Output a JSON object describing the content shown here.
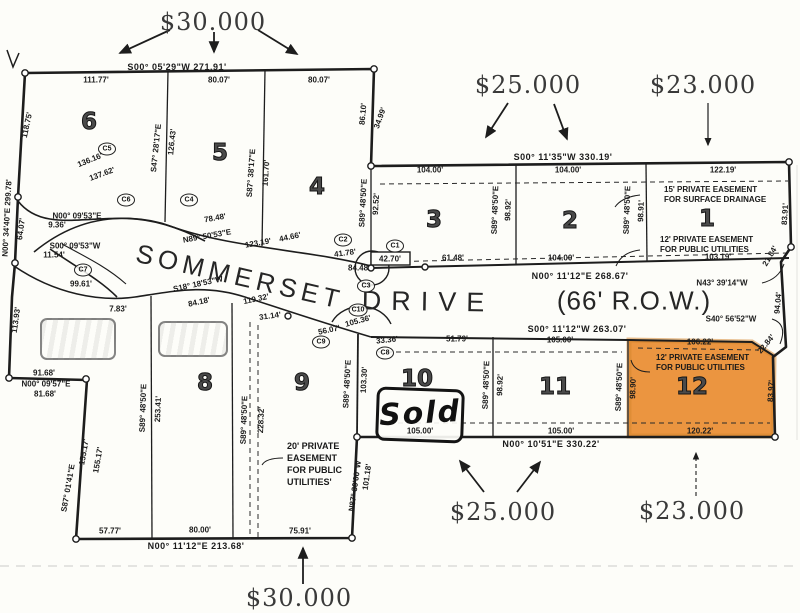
{
  "colors": {
    "paper": "#fdfdf9",
    "ink": "#1d1d1d",
    "lot12_highlight": "#ea8a2c"
  },
  "prices": {
    "top_30": "$30.000",
    "top_25": "$25.000",
    "top_23": "$23.000",
    "bottom_25": "$25.000",
    "bottom_23": "$23.000",
    "bottom_30": "$30.000"
  },
  "street": {
    "sommerset": "SOMMERSET",
    "drive": "DRIVE",
    "row": "(66' R.O.W.)"
  },
  "annotations": {
    "sold": "Sold"
  },
  "easements": {
    "surface_ne": "15' PRIVATE EASEMENT\nFOR SURFACE DRAINAGE",
    "utilities_ne": "12' PRIVATE EASEMENT\nFOR PUBLIC UTILITIES",
    "utilities_lot12": "12' PRIVATE EASEMENT\nFOR PUBLIC UTILITIES",
    "utilities_sw": "20' PRIVATE\nEASEMENT\nFOR PUBLIC\nUTILITIES'"
  },
  "lots": [
    {
      "n": "6",
      "x": 89,
      "y": 122
    },
    {
      "n": "5",
      "x": 220,
      "y": 153
    },
    {
      "n": "4",
      "x": 317,
      "y": 187
    },
    {
      "n": "3",
      "x": 434,
      "y": 220
    },
    {
      "n": "2",
      "x": 570,
      "y": 221
    },
    {
      "n": "1",
      "x": 707,
      "y": 219
    },
    {
      "n": "8",
      "x": 205,
      "y": 383
    },
    {
      "n": "9",
      "x": 302,
      "y": 383
    },
    {
      "n": "10",
      "x": 417,
      "y": 379
    },
    {
      "n": "11",
      "x": 555,
      "y": 387
    },
    {
      "n": "12",
      "x": 692,
      "y": 387
    }
  ],
  "curve_labels": [
    {
      "t": "C1",
      "x": 395,
      "y": 246
    },
    {
      "t": "C2",
      "x": 343,
      "y": 240
    },
    {
      "t": "C3",
      "x": 366,
      "y": 286
    },
    {
      "t": "C4",
      "x": 189,
      "y": 200
    },
    {
      "t": "C5",
      "x": 107,
      "y": 149
    },
    {
      "t": "C6",
      "x": 126,
      "y": 200
    },
    {
      "t": "C7",
      "x": 83,
      "y": 270
    },
    {
      "t": "C8",
      "x": 385,
      "y": 353
    },
    {
      "t": "C9",
      "x": 321,
      "y": 342
    },
    {
      "t": "C10",
      "x": 358,
      "y": 310
    }
  ],
  "dim_labels": [
    {
      "t": "S00° 05'29\"W   271.91'",
      "x": 177,
      "y": 67,
      "big": 1
    },
    {
      "t": "111.77'",
      "x": 96,
      "y": 80
    },
    {
      "t": "80.07'",
      "x": 219,
      "y": 80
    },
    {
      "t": "80.07'",
      "x": 319,
      "y": 80
    },
    {
      "t": "118.75'",
      "x": 27,
      "y": 125,
      "r": -78
    },
    {
      "t": "136.16'",
      "x": 90,
      "y": 160,
      "r": -22
    },
    {
      "t": "137.62'",
      "x": 102,
      "y": 174,
      "r": -20
    },
    {
      "t": "S47° 28'17\"E",
      "x": 156,
      "y": 148,
      "r": -84
    },
    {
      "t": "126.43'",
      "x": 172,
      "y": 142,
      "r": -84
    },
    {
      "t": "S87° 38'17\"E",
      "x": 251,
      "y": 173,
      "r": -86
    },
    {
      "t": "161.70'",
      "x": 266,
      "y": 173,
      "r": -86
    },
    {
      "t": "86.10'",
      "x": 363,
      "y": 114,
      "r": -85
    },
    {
      "t": "34.99'",
      "x": 380,
      "y": 118,
      "r": -70
    },
    {
      "t": "S89° 48'50\"E",
      "x": 363,
      "y": 203,
      "r": -87
    },
    {
      "t": "92.52'",
      "x": 376,
      "y": 204,
      "r": -87
    },
    {
      "t": "S00° 11'35\"W   330.19'",
      "x": 563,
      "y": 157,
      "big": 1
    },
    {
      "t": "104.00'",
      "x": 430,
      "y": 170
    },
    {
      "t": "104.00'",
      "x": 568,
      "y": 170
    },
    {
      "t": "122.19'",
      "x": 723,
      "y": 170
    },
    {
      "t": "S89° 48'50\"E",
      "x": 495,
      "y": 210,
      "r": -88
    },
    {
      "t": "98.92'",
      "x": 508,
      "y": 210,
      "r": -88
    },
    {
      "t": "S89° 48'50\"E",
      "x": 627,
      "y": 210,
      "r": -88
    },
    {
      "t": "98.91'",
      "x": 641,
      "y": 211,
      "r": -88
    },
    {
      "t": "83.91'",
      "x": 785,
      "y": 214,
      "r": -87
    },
    {
      "t": "41.78'",
      "x": 345,
      "y": 253,
      "r": -8
    },
    {
      "t": "42.70'",
      "x": 390,
      "y": 259
    },
    {
      "t": "84.48'",
      "x": 359,
      "y": 268
    },
    {
      "t": "61.48'",
      "x": 453,
      "y": 258
    },
    {
      "t": "104.00'",
      "x": 561,
      "y": 258
    },
    {
      "t": "103.19'",
      "x": 718,
      "y": 257
    },
    {
      "t": "N00° 11'12\"E   268.67'",
      "x": 580,
      "y": 276,
      "big": 1
    },
    {
      "t": "N43° 39'14\"W",
      "x": 722,
      "y": 283
    },
    {
      "t": "21.84'",
      "x": 770,
      "y": 256,
      "r": -60
    },
    {
      "t": "94.04'",
      "x": 778,
      "y": 303,
      "r": -85
    },
    {
      "t": "S40° 56'52\"W",
      "x": 731,
      "y": 319
    },
    {
      "t": "22.84'",
      "x": 766,
      "y": 344,
      "r": -50
    },
    {
      "t": "N00° 09'53\"E",
      "x": 77,
      "y": 216
    },
    {
      "t": "9.36'",
      "x": 57,
      "y": 225
    },
    {
      "t": "S00° 09'53\"W",
      "x": 75,
      "y": 246
    },
    {
      "t": "11.54'",
      "x": 54,
      "y": 255
    },
    {
      "t": "78.48'",
      "x": 215,
      "y": 218,
      "r": -10
    },
    {
      "t": "N89° 50'53\"E",
      "x": 207,
      "y": 236,
      "r": -10
    },
    {
      "t": "123.19'",
      "x": 258,
      "y": 243,
      "r": -10
    },
    {
      "t": "44.66'",
      "x": 290,
      "y": 237,
      "r": -12
    },
    {
      "t": "99.61'",
      "x": 81,
      "y": 284
    },
    {
      "t": "7.83'",
      "x": 118,
      "y": 309
    },
    {
      "t": "S18° 18'53\"W",
      "x": 198,
      "y": 284,
      "r": -12
    },
    {
      "t": "119.32'",
      "x": 256,
      "y": 299,
      "r": -12
    },
    {
      "t": "84.18'",
      "x": 199,
      "y": 302,
      "r": -12
    },
    {
      "t": "31.14'",
      "x": 270,
      "y": 316,
      "r": -8
    },
    {
      "t": "56.07'",
      "x": 329,
      "y": 330,
      "r": -12
    },
    {
      "t": "105.36'",
      "x": 358,
      "y": 321,
      "r": -15
    },
    {
      "t": "33.36'",
      "x": 387,
      "y": 340,
      "r": -6
    },
    {
      "t": "S00° 11'12\"W   263.07'",
      "x": 577,
      "y": 329,
      "big": 1
    },
    {
      "t": "51.79'",
      "x": 457,
      "y": 339
    },
    {
      "t": "105.00'",
      "x": 560,
      "y": 340
    },
    {
      "t": "106.22'",
      "x": 700,
      "y": 342
    },
    {
      "t": "S89° 48'50\"E",
      "x": 347,
      "y": 384,
      "r": -87
    },
    {
      "t": "103.30'",
      "x": 364,
      "y": 380,
      "r": -87
    },
    {
      "t": "S89° 48'50\"E",
      "x": 486,
      "y": 385,
      "r": -88
    },
    {
      "t": "98.92'",
      "x": 500,
      "y": 385,
      "r": -88
    },
    {
      "t": "S89° 48'50\"E",
      "x": 619,
      "y": 387,
      "r": -88
    },
    {
      "t": "98.90'",
      "x": 633,
      "y": 388,
      "r": -88
    },
    {
      "t": "83.97'",
      "x": 771,
      "y": 391,
      "r": -87
    },
    {
      "t": "105.00'",
      "x": 420,
      "y": 431
    },
    {
      "t": "105.00'",
      "x": 561,
      "y": 431
    },
    {
      "t": "120.22'",
      "x": 700,
      "y": 431
    },
    {
      "t": "N00° 10'51\"E   330.22'",
      "x": 551,
      "y": 444,
      "big": 1
    },
    {
      "t": "S89° 48'50\"E",
      "x": 143,
      "y": 408,
      "r": -88
    },
    {
      "t": "253.41'",
      "x": 158,
      "y": 409,
      "r": -88
    },
    {
      "t": "S89° 48'50\"E",
      "x": 244,
      "y": 420,
      "r": -88
    },
    {
      "t": "228.32'",
      "x": 261,
      "y": 420,
      "r": -88
    },
    {
      "t": "101.18'",
      "x": 367,
      "y": 477,
      "r": -82
    },
    {
      "t": "N87° 30'00\"W",
      "x": 355,
      "y": 486,
      "r": -82
    },
    {
      "t": "57.77'",
      "x": 110,
      "y": 531
    },
    {
      "t": "80.00'",
      "x": 200,
      "y": 530
    },
    {
      "t": "75.91'",
      "x": 300,
      "y": 531
    },
    {
      "t": "N00° 11'12\"E   213.68'",
      "x": 196,
      "y": 546,
      "big": 1
    },
    {
      "t": "155.17'",
      "x": 84,
      "y": 452,
      "r": -80
    },
    {
      "t": "155.17'",
      "x": 98,
      "y": 460,
      "r": -80
    },
    {
      "t": "S87° 01'41\"E",
      "x": 68,
      "y": 488,
      "r": -80
    },
    {
      "t": "91.68'",
      "x": 44,
      "y": 373
    },
    {
      "t": "N00° 09'57\"E",
      "x": 46,
      "y": 384
    },
    {
      "t": "81.68'",
      "x": 45,
      "y": 394
    },
    {
      "t": "113.93'",
      "x": 16,
      "y": 320,
      "r": -82
    },
    {
      "t": "64.07'",
      "x": 21,
      "y": 229,
      "r": -82
    },
    {
      "t": "N00° 34'40\"E  299.78'",
      "x": 7,
      "y": 218,
      "r": -87
    }
  ]
}
